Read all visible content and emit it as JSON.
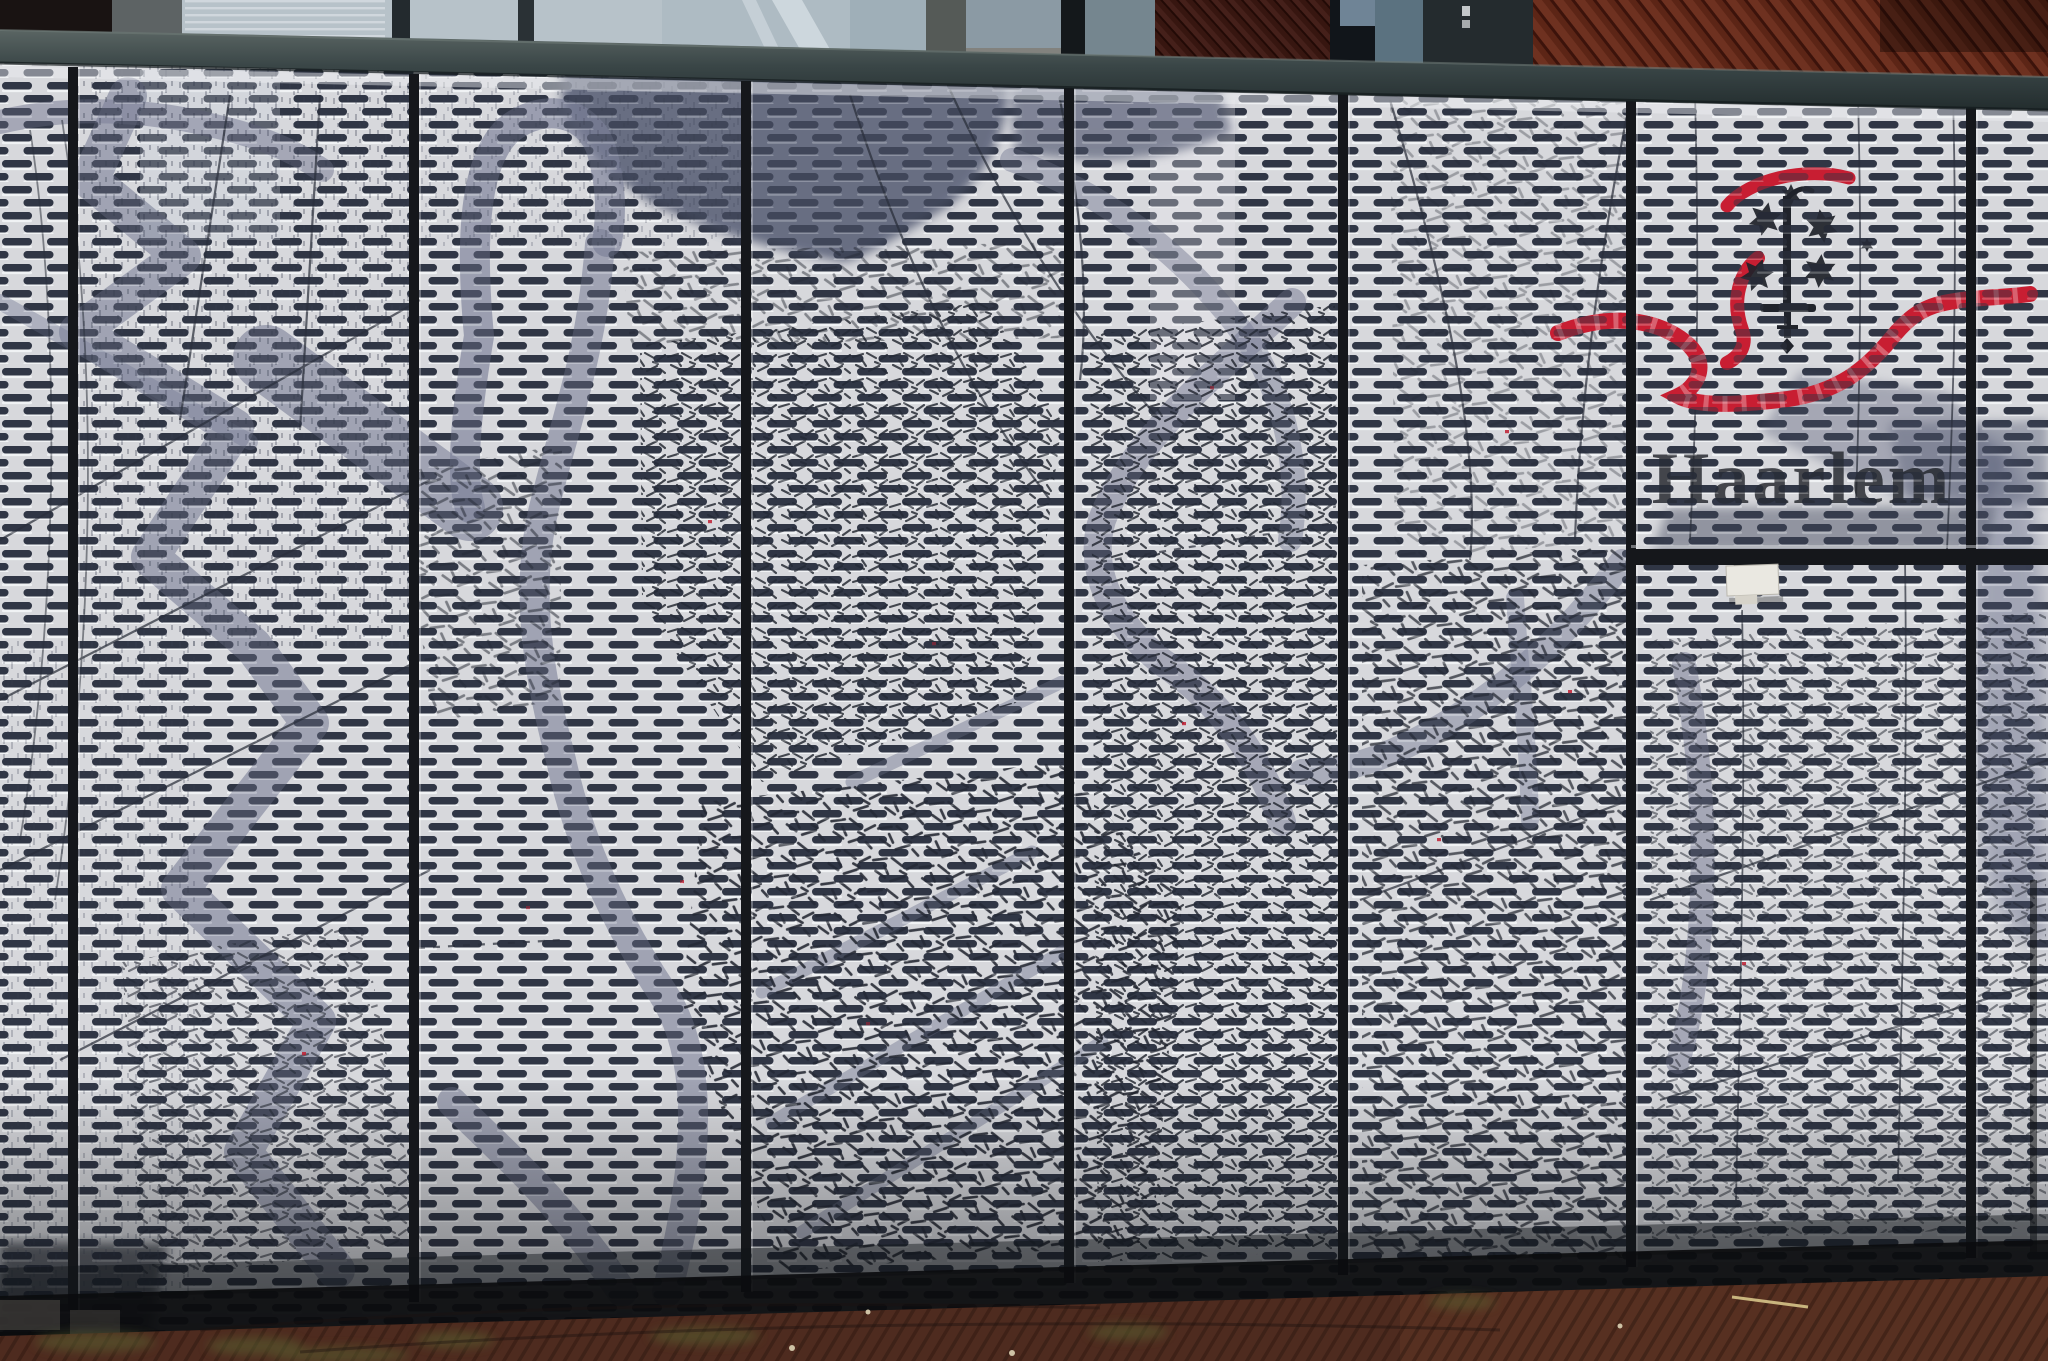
{
  "signage": {
    "city_name": "Haarlem"
  },
  "emblem": {
    "icons": [
      "sword-icon",
      "six-pointed-star-icon",
      "ribbon-icon"
    ],
    "star_count": 6
  },
  "facade": {
    "panel_count": 7
  },
  "colors": {
    "ribbon_red": "#c81e32",
    "city_name_ink": "#23262c",
    "emblem_ink": "#20232b",
    "mesh_base": "#d7d8dc",
    "mesh_dash": "#323848",
    "map_water_gray": "#7b8098",
    "map_ink": "#1d212b",
    "frame_dark": "#15171b",
    "rail_slate": "#3a4647",
    "brick_red_brown": "#5c2516",
    "pavement_brown": "#4e2b1f"
  }
}
